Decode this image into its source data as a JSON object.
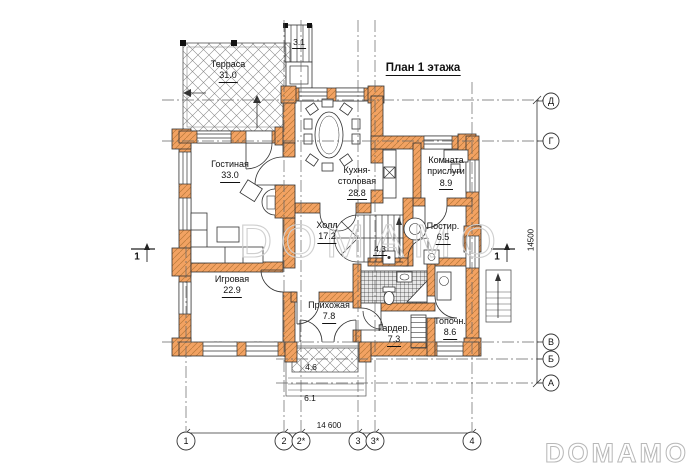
{
  "title": "План 1 этажа",
  "rooms": [
    {
      "name": "Терраса",
      "area": "31.0"
    },
    {
      "name": "Гостиная",
      "area": "33.0"
    },
    {
      "name": "Кухня-столовая",
      "area": "28.8"
    },
    {
      "name": "Комната прислуги",
      "area": "8.9"
    },
    {
      "name": "Холл",
      "area": "17.2"
    },
    {
      "name": "Постир.",
      "area": "6.5"
    },
    {
      "name": "Игровая",
      "area": "22.9"
    },
    {
      "name": "Прихожая",
      "area": "7.8"
    },
    {
      "name": "Гардер.",
      "area": "7.3"
    },
    {
      "name": "Топочн.",
      "area": "8.6"
    }
  ],
  "annotations": {
    "top_steps_area": "3.1",
    "stair_area": "4.3",
    "porch_area": "4.6",
    "porch_width": "6.1"
  },
  "dimensions": {
    "overall_width": "14 600",
    "overall_height": "14500"
  },
  "axes": {
    "rows": [
      "Д",
      "Г",
      "В",
      "Б",
      "А"
    ],
    "cols": [
      "1",
      "2",
      "2*",
      "3",
      "3*",
      "4"
    ]
  },
  "section_marks": {
    "left": "1",
    "right": "1"
  },
  "watermark": {
    "center": "DOMAMO",
    "corner": "DOMAMO"
  },
  "colors": {
    "wall": "#F2A262",
    "line": "#1a1a1a",
    "watermark": "#cccccc"
  }
}
